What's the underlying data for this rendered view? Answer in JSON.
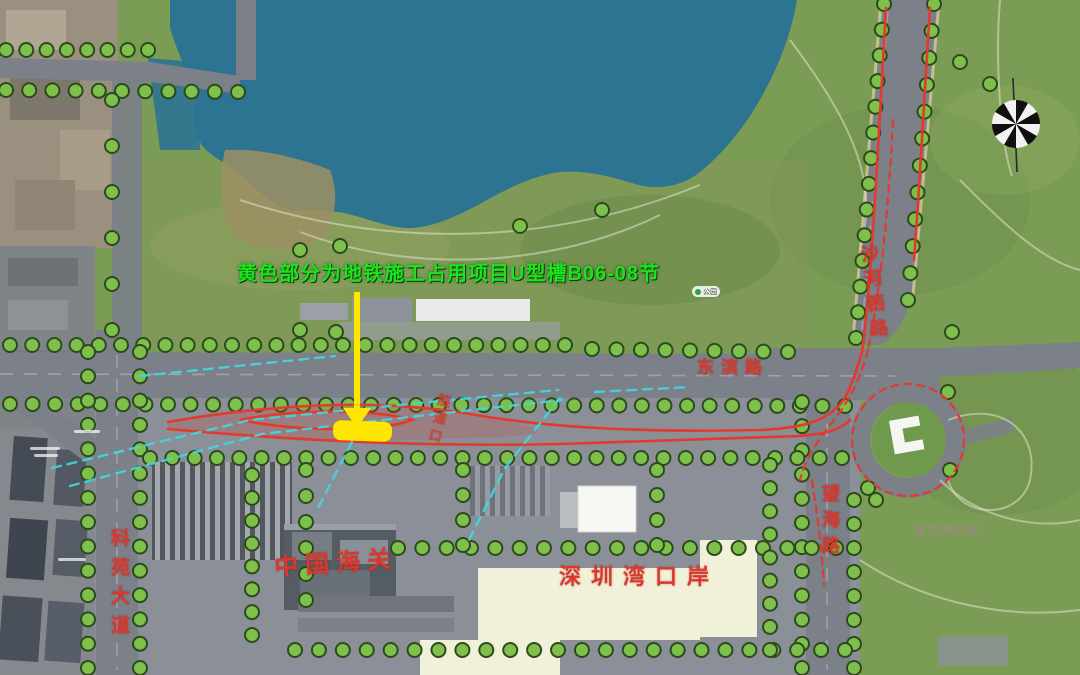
{
  "annotation": {
    "note": "黄色部分为地铁施工占用项目U型槽B06-08节",
    "highlight_label": "U型槽B06-08节占用段"
  },
  "road_labels": {
    "dongbin": "东滨路",
    "keyuan": "科苑大道",
    "shahexi": "沙河西路",
    "wanghai": "望海路",
    "suidaokou": "隧道口"
  },
  "place_labels": {
    "customs": "中国海关",
    "port": "深圳湾口岸",
    "bay_park": "深圳湾公园",
    "poi_park": "公园"
  },
  "colors": {
    "water": "#2d7392",
    "grass": "#7b9c55",
    "road": "#7b8089",
    "port_ground": "#8a8f98",
    "tree_fill": "#7fbf4b",
    "tree_edge": "#2c4b1c",
    "route_red": "#e23a2c",
    "tunnel_cyan": "#3fd8e2",
    "highlight_yellow": "#ffe600",
    "note_green": "#1ce41c",
    "label_red": "#dd372b",
    "plaza_cream": "#f1f0d8"
  }
}
